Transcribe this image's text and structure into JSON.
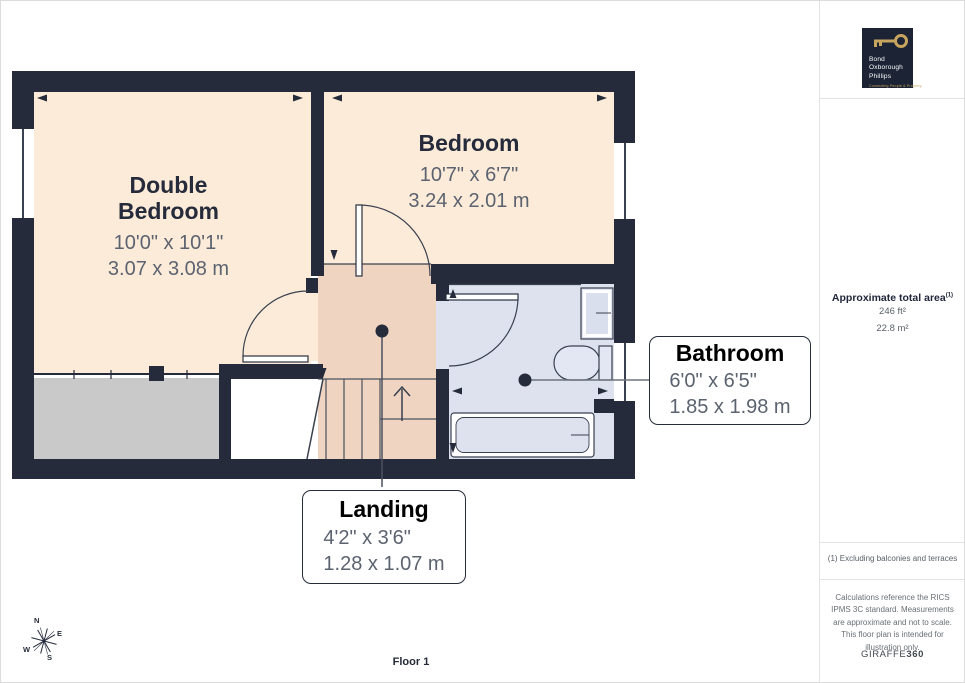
{
  "colors": {
    "wall": "#252b3a",
    "bedroom_fill": "#fcebd8",
    "landing_fill": "#eed4c1",
    "bathroom_fill": "#dde2ee",
    "void_fill": "#c9c9c9",
    "logo_navy": "#1b2334",
    "gold": "#c8a55f",
    "dim_text": "#5c6370"
  },
  "plan": {
    "floor_label": "Floor 1",
    "rooms": {
      "double_bedroom": {
        "name": "Double Bedroom",
        "imperial": "10'0\" x 10'1\"",
        "metric": "3.07 x 3.08 m"
      },
      "bedroom": {
        "name": "Bedroom",
        "imperial": "10'7\" x 6'7\"",
        "metric": "3.24 x 2.01 m"
      },
      "bathroom": {
        "name": "Bathroom",
        "imperial": "6'0\" x 6'5\"",
        "metric": "1.85 x 1.98 m"
      },
      "landing": {
        "name": "Landing",
        "imperial": "4'2\" x 3'6\"",
        "metric": "1.28 x 1.07 m"
      }
    },
    "compass": {
      "north": "N",
      "east": "E",
      "south": "S",
      "west": "W"
    }
  },
  "sidebar": {
    "logo": {
      "line1": "Bond",
      "line2": "Oxborough",
      "line3": "Phillips",
      "tagline": "Connecting People & Property"
    },
    "area": {
      "title": "Approximate total area",
      "footnote_marker": "(1)",
      "imperial": "246 ft²",
      "metric": "22.8 m²"
    },
    "footnote": "(1) Excluding balconies and terraces",
    "disclaimer": "Calculations reference the RICS IPMS 3C standard. Measurements are approximate and not to scale. This floor plan is intended for illustration only.",
    "brand": {
      "name": "GIRAFFE",
      "suffix": "360"
    }
  }
}
